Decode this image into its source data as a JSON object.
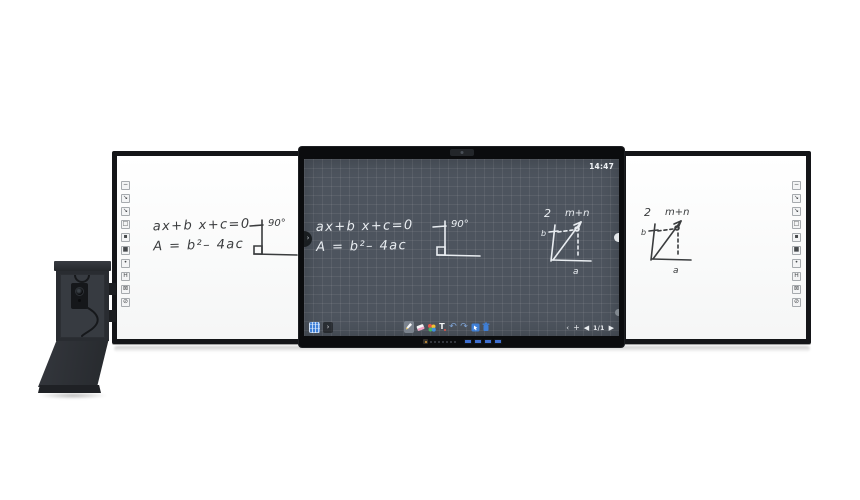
{
  "display": {
    "clock": "14:47",
    "canvas": {
      "eq1": "ax+b x+c=0",
      "eq2": "A = b²– 4ac",
      "angle_label": "90°",
      "fig_index": "2",
      "fig_title": "m+n",
      "fig_left_label": "b",
      "fig_bottom_label": "a"
    },
    "toolbar": {
      "expand_glyph": "›",
      "tools": [
        {
          "name": "pen",
          "selected": true
        },
        {
          "name": "eraser"
        },
        {
          "name": "palette"
        },
        {
          "name": "text",
          "label": "T"
        },
        {
          "name": "undo",
          "glyph": "↶"
        },
        {
          "name": "redo",
          "glyph": "↷"
        },
        {
          "name": "select"
        },
        {
          "name": "delete"
        }
      ],
      "nav": {
        "collapse_glyph": "‹",
        "add_glyph": "+",
        "prev_glyph": "◀",
        "page": "1/1",
        "next_glyph": "▶"
      }
    },
    "colors": {
      "screen_bg": "#4d545e",
      "grid_line": "#5d6570",
      "accent_blue": "#3f7fd6",
      "eraser_pink": "#ef9fc0",
      "power_led": "#d99a3d",
      "usb_port": "#3f6fd0"
    }
  },
  "left_board": {
    "eq1": "ax+b x+c=0",
    "eq2": "A = b²– 4ac",
    "angle_label": "90°",
    "tool_icons": [
      {
        "name": "line",
        "glyph": "−"
      },
      {
        "name": "pen-thin",
        "glyph": "↘"
      },
      {
        "name": "pen-thick",
        "glyph": "↘"
      },
      {
        "name": "eraser-board",
        "glyph": "□"
      },
      {
        "name": "dot-small",
        "glyph": "▪"
      },
      {
        "name": "dot-medium",
        "glyph": "■"
      },
      {
        "name": "dot-large",
        "glyph": "•"
      },
      {
        "name": "highlight",
        "glyph": "H"
      },
      {
        "name": "clear-box",
        "glyph": "⊠"
      },
      {
        "name": "clear-all",
        "glyph": "⊘"
      }
    ]
  },
  "right_board": {
    "fig_index": "2",
    "fig_title": "m+n",
    "fig_left_label": "b",
    "fig_bottom_label": "a",
    "tool_icons": [
      {
        "name": "line",
        "glyph": "−"
      },
      {
        "name": "pen-thin",
        "glyph": "↘"
      },
      {
        "name": "pen-thick",
        "glyph": "↘"
      },
      {
        "name": "eraser-board",
        "glyph": "□"
      },
      {
        "name": "dot-small",
        "glyph": "▪"
      },
      {
        "name": "dot-medium",
        "glyph": "■"
      },
      {
        "name": "dot-large",
        "glyph": "•"
      },
      {
        "name": "highlight",
        "glyph": "H"
      },
      {
        "name": "clear-box",
        "glyph": "⊠"
      },
      {
        "name": "clear-all",
        "glyph": "⊘"
      }
    ]
  }
}
